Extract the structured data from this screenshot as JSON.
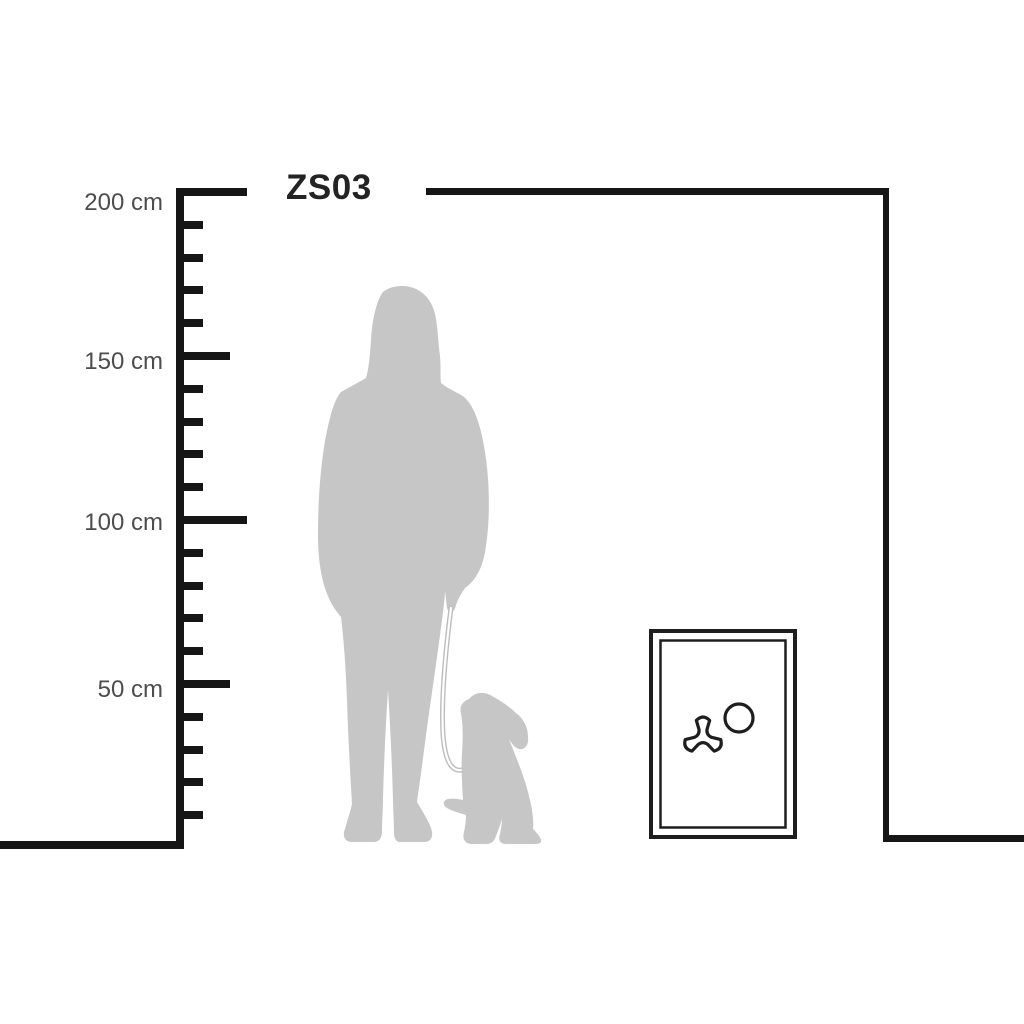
{
  "title": "ZS03",
  "ruler": {
    "unit": "cm",
    "labels": [
      {
        "value": 200,
        "text": "200 cm"
      },
      {
        "value": 150,
        "text": "150 cm"
      },
      {
        "value": 100,
        "text": "100 cm"
      },
      {
        "value": 50,
        "text": "50 cm"
      }
    ],
    "ticks": {
      "min_cm": 10,
      "max_cm": 200,
      "step_cm": 10,
      "medium_every_cm": 50,
      "major_every_cm": 100
    }
  },
  "scene": {
    "figures": [
      {
        "name": "woman-silhouette"
      },
      {
        "name": "leash-line"
      },
      {
        "name": "sitting-dog-silhouette"
      },
      {
        "name": "safe-front",
        "details": [
          "tri-spoke-handle-icon",
          "lock-dial-circle-icon"
        ]
      }
    ]
  },
  "colors": {
    "background": "#ffffff",
    "line": "#161616",
    "silhouette": "#c6c6c6",
    "label_text": "#4d4d4d",
    "title_text": "#232323"
  }
}
